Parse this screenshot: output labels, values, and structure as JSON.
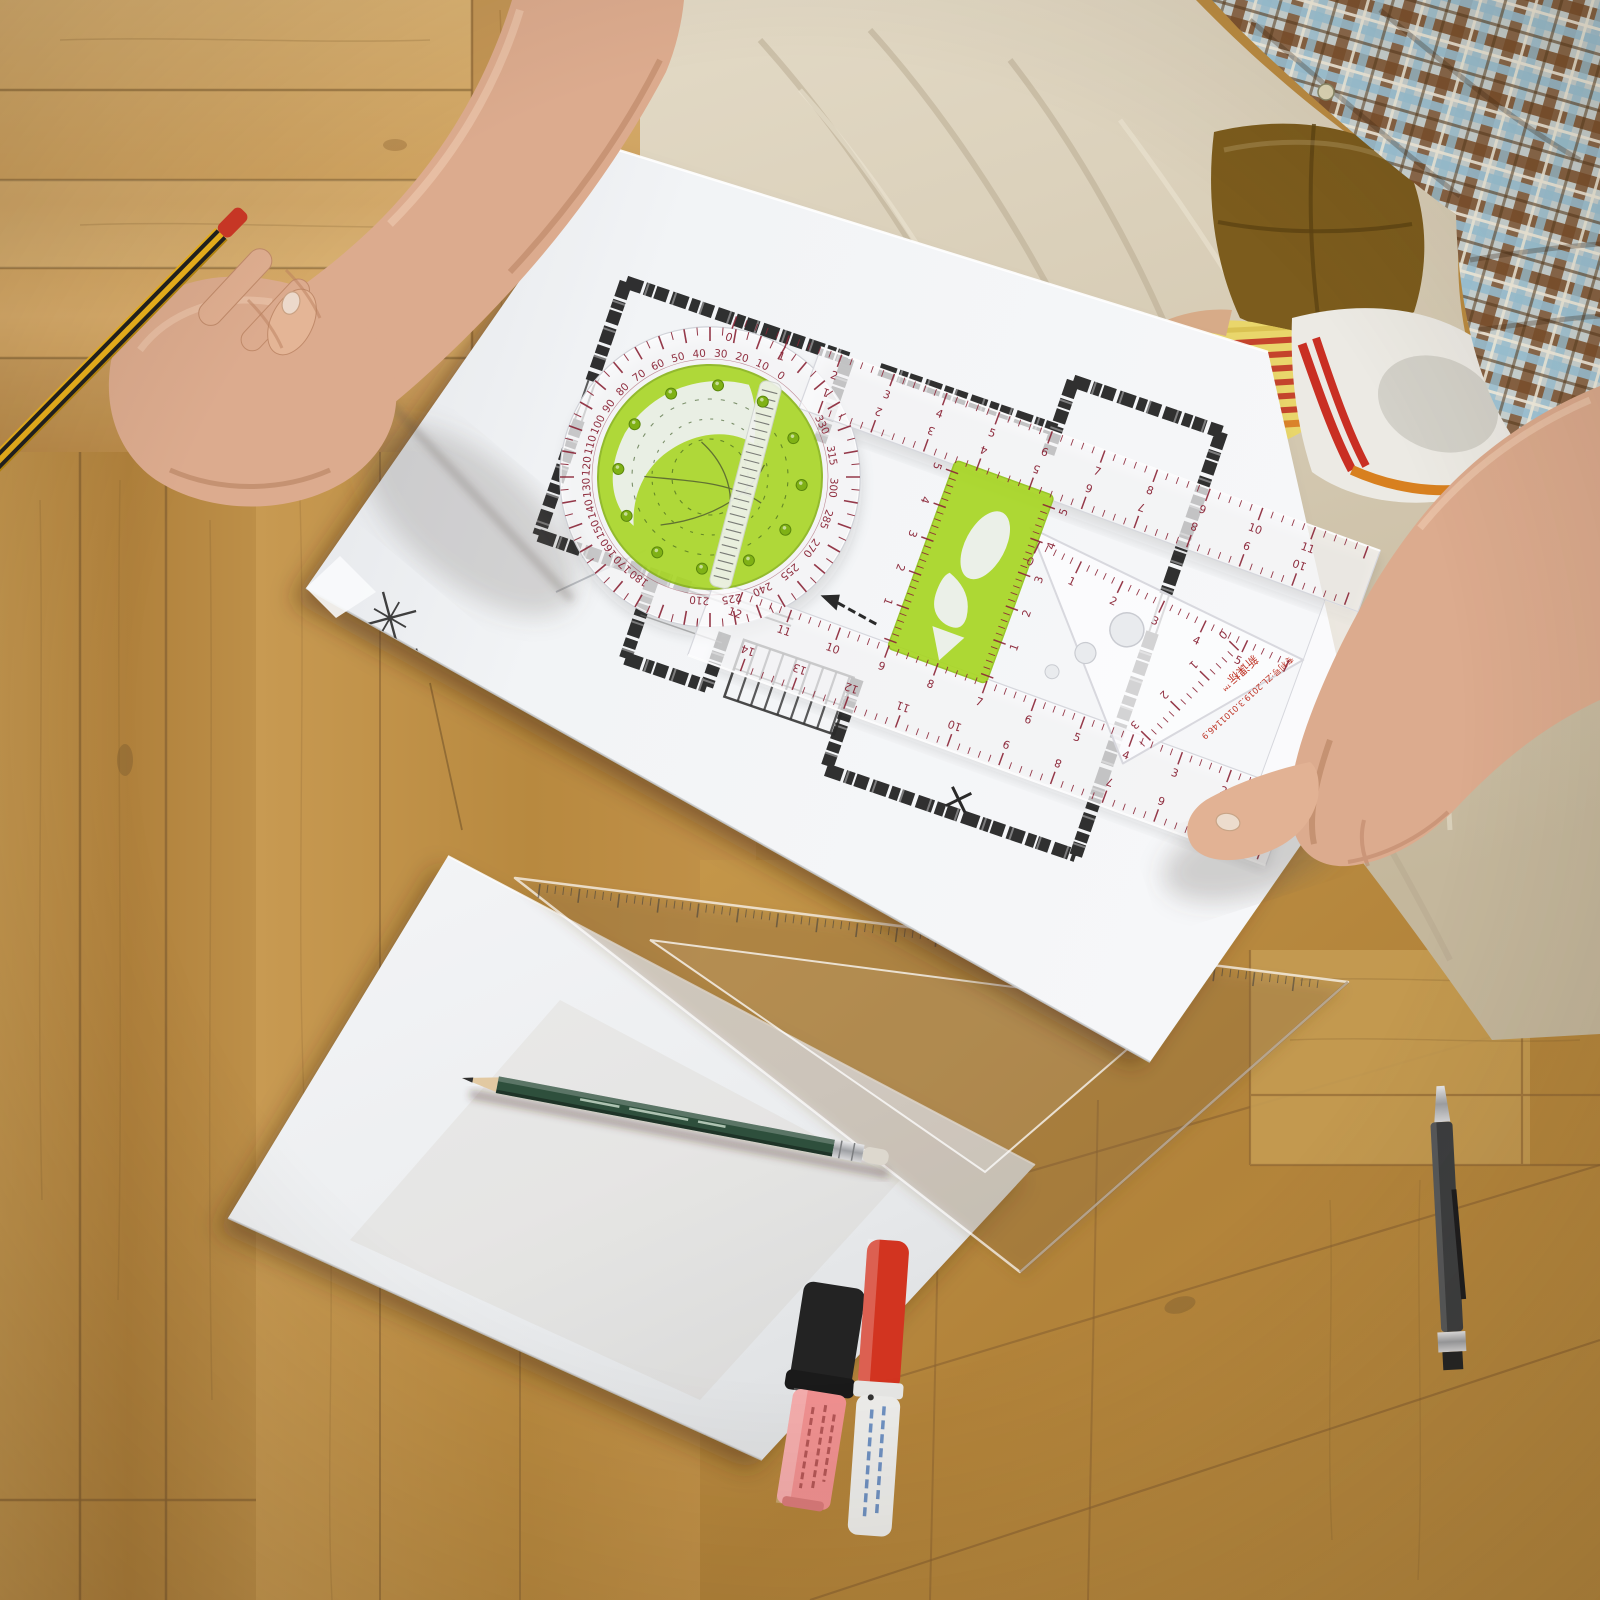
{
  "scene": {
    "description": "overhead photo of a person on a parquet wood floor drawing an architectural floor plan with a multifunction drafting ruler",
    "compass": {
      "label": "N"
    }
  },
  "tool": {
    "protractor": {
      "outer_scale": {
        "from": 0,
        "to": 180,
        "step": 10
      },
      "inner_scale": {
        "from": 210,
        "to": 330,
        "step": 15
      },
      "tick_deg": 5,
      "ink": "#8a2436"
    },
    "linear_scales": [
      {
        "id": "top-arm-outer",
        "x1": -30,
        "y1": -160,
        "x2": 648,
        "y2": -160,
        "major": 56,
        "side": 1,
        "flip": false,
        "labels": {
          "from": 0,
          "to": 11,
          "step": 1
        }
      },
      {
        "id": "top-arm-inner",
        "x1": 80,
        "y1": -97,
        "x2": 648,
        "y2": -97,
        "major": 56,
        "side": -1,
        "flip": true,
        "labels": {
          "from": 1,
          "to": 10,
          "step": 1
        }
      },
      {
        "id": "bottom-arm-inner",
        "x1": 70,
        "y1": 97,
        "x2": 648,
        "y2": 97,
        "major": 52,
        "side": 1,
        "flip": false,
        "labels": {
          "from": 12,
          "to": 1,
          "step": -1
        }
      },
      {
        "id": "bottom-arm-outer",
        "x1": 95,
        "y1": 172,
        "x2": 648,
        "y2": 172,
        "major": 55,
        "side": -1,
        "flip": true,
        "labels": {
          "from": 14,
          "to": 4,
          "step": -1
        }
      },
      {
        "id": "slider-left",
        "x1": 232,
        "y1": -88,
        "x2": 232,
        "y2": 96,
        "major": 36,
        "side": 1,
        "flip": false,
        "labels": {
          "from": 5,
          "to": 1,
          "step": -1
        }
      },
      {
        "id": "slider-right",
        "x1": 322,
        "y1": -88,
        "x2": 322,
        "y2": 96,
        "major": 36,
        "side": -1,
        "flip": true,
        "labels": {
          "from": 5,
          "to": 1,
          "step": -1
        }
      },
      {
        "id": "triangle-hyp",
        "x1": 332,
        "y1": -52,
        "x2": 608,
        "y2": -26,
        "major": 46,
        "side": 1,
        "flip": false,
        "labels": {
          "from": 0,
          "to": 5,
          "step": 1
        }
      },
      {
        "id": "triangle-inner",
        "x1": 556,
        "y1": -18,
        "x2": 498,
        "y2": 110,
        "major": 42,
        "side": 1,
        "flip": false,
        "labels": {
          "from": 0,
          "to": 3,
          "step": 1
        }
      }
    ],
    "setsquare_scale": {
      "x1": 540,
      "y1": 884,
      "x2": 1326,
      "y2": 981,
      "minor": 8,
      "color": "#3c3c3c"
    },
    "brand_text": "新课标™",
    "patent_text": "专利号:ZL.2019.3.0101146.9",
    "colors": {
      "plastic": "rgba(252,252,254,0.74)",
      "green": "#a6d51f",
      "rivet": "#7fb115",
      "ink": "#8a2436"
    }
  },
  "palette": {
    "wood_light": "#d3a768",
    "wood_mid": "#bd8f4a",
    "wood_dark": "#a87c3a",
    "paper": "#f1f3f5",
    "plan_ink": "#1e1e1e",
    "khaki": "#d6cbb4",
    "plaid_brown": "#7c4f2a",
    "plaid_blue": "#9cc4d8",
    "skin": "#dcab8e",
    "cushion_olive": "#7c5c1d",
    "sock_yellow": "#e9d66b",
    "lace_red": "#c92f23",
    "stripe_orange": "#d8801f",
    "pencil_yellow": "#e9b01c",
    "pencil_green": "#2e4f3c",
    "highlighter_pink": "#ef9090",
    "marker_red": "#d23420",
    "pen_black": "#3c3e40"
  }
}
